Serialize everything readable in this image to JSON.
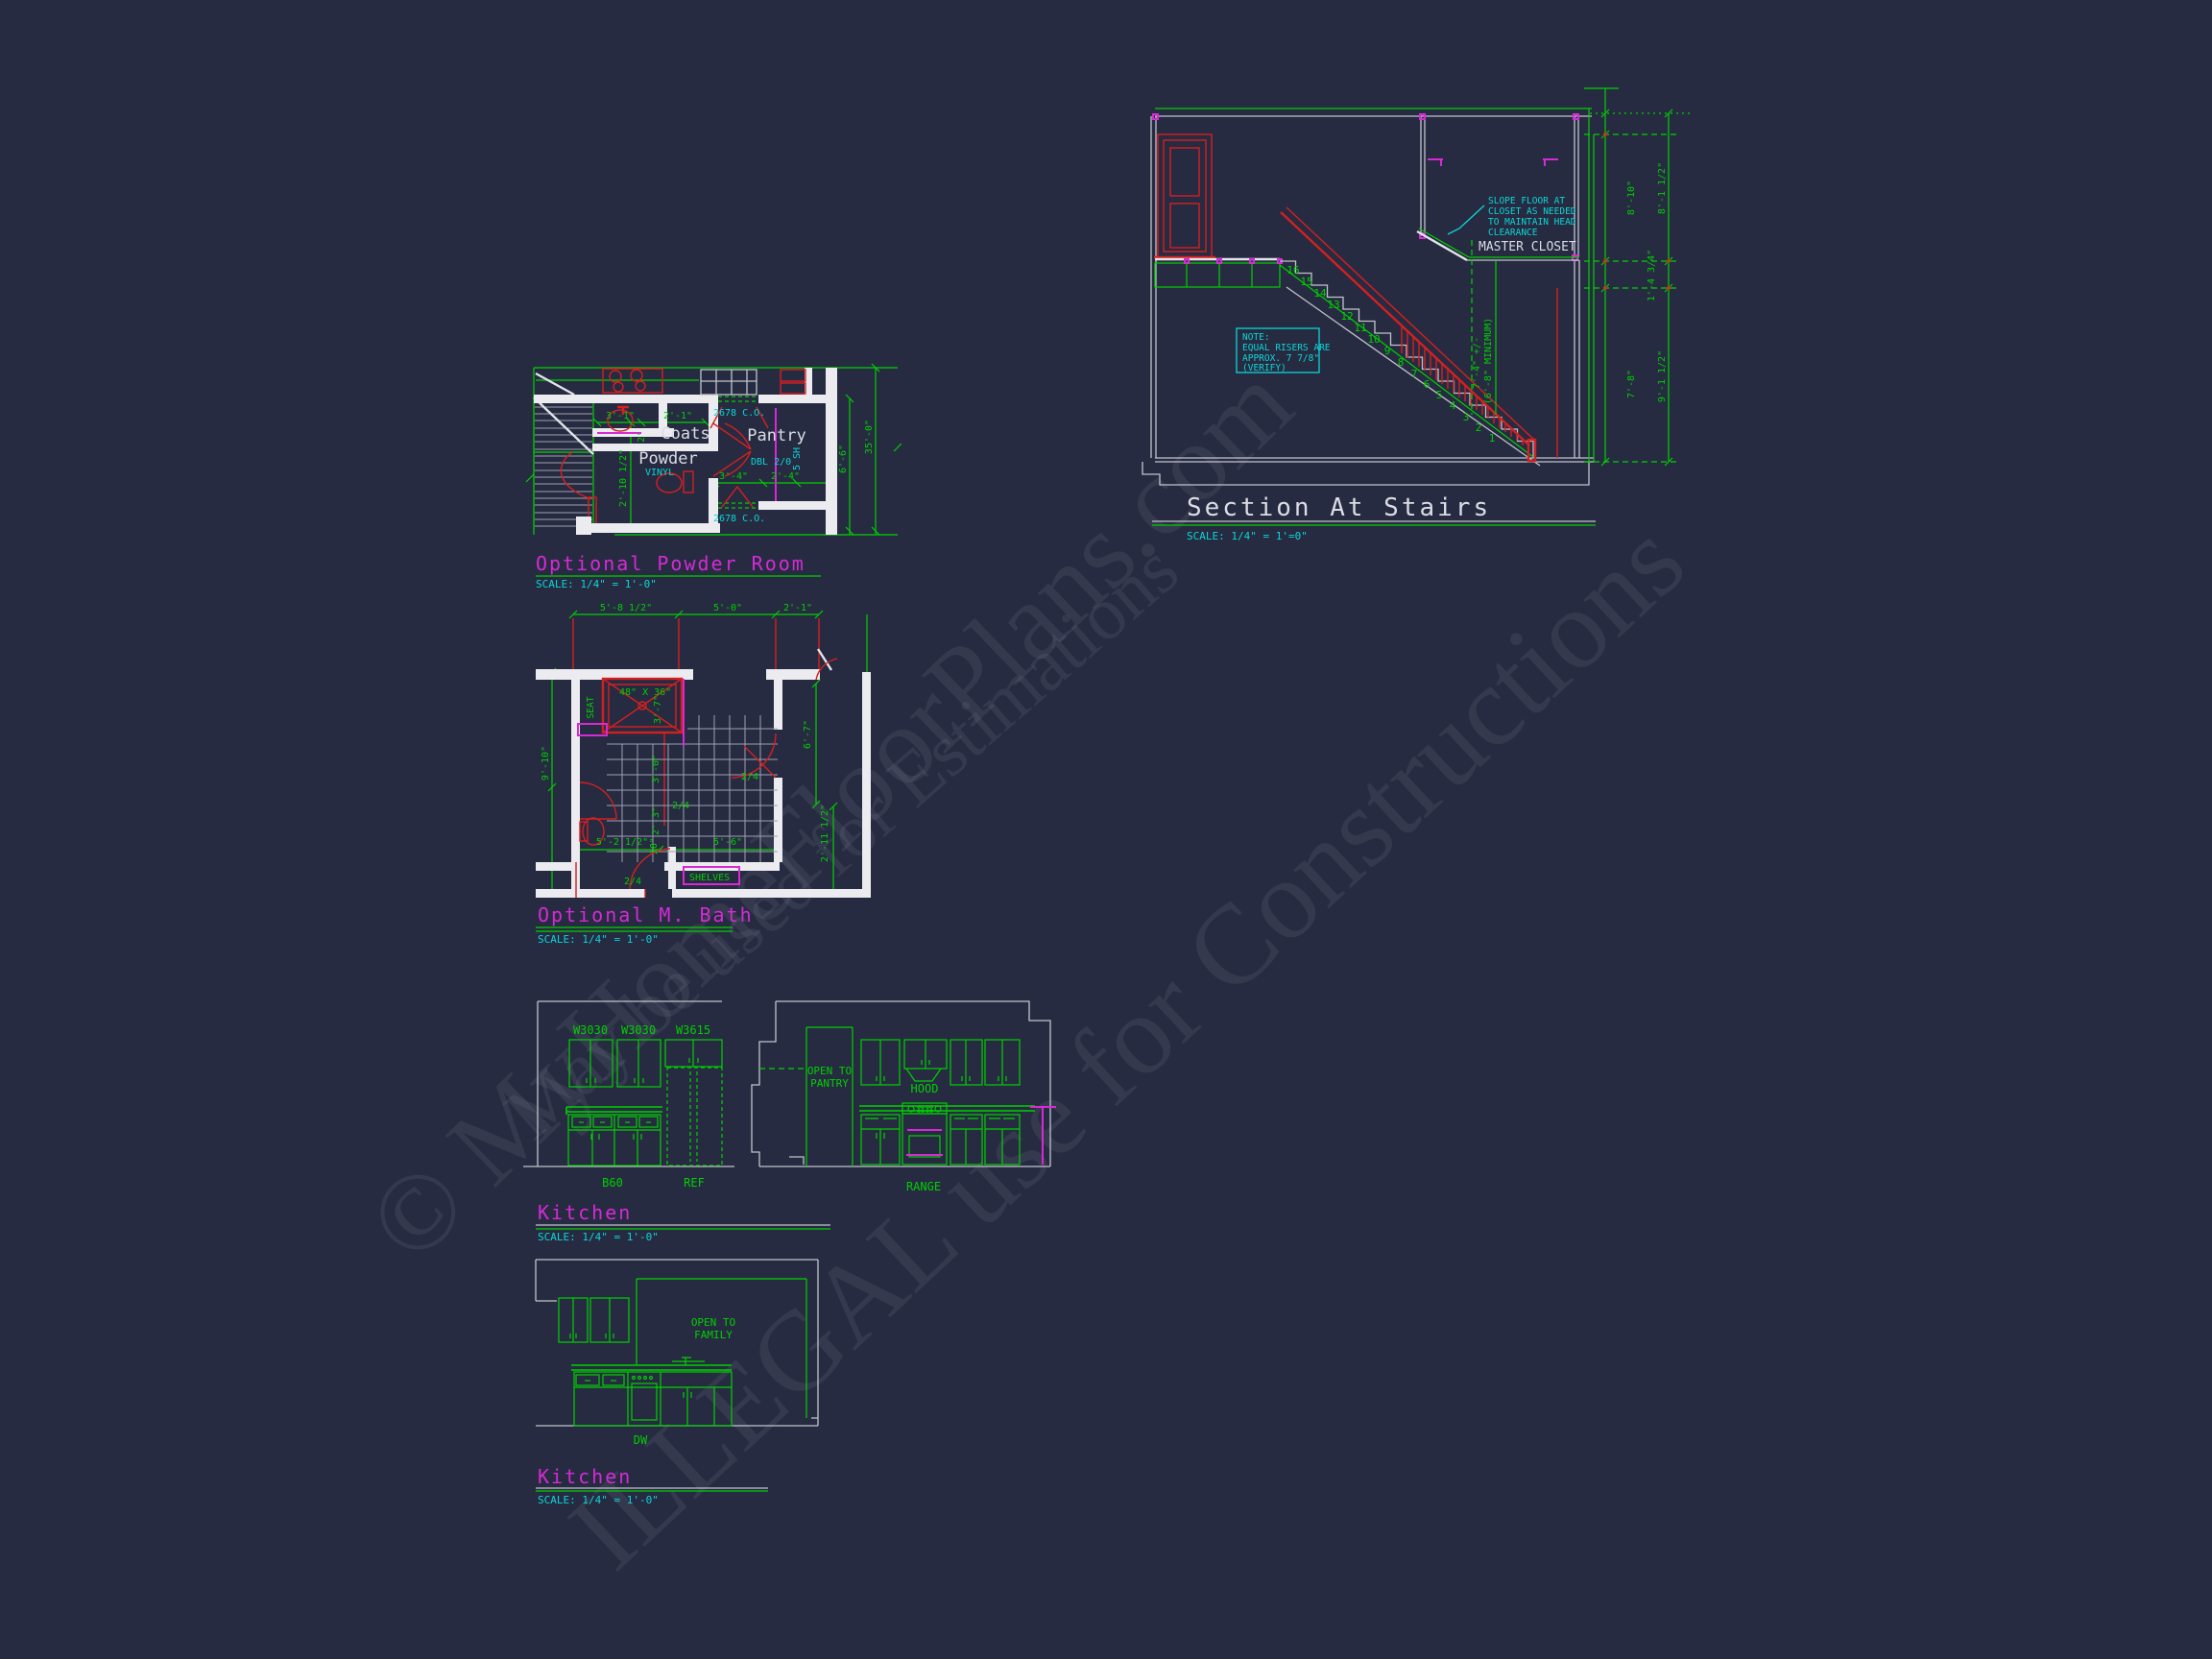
{
  "drawing": {
    "watermark": {
      "line1": "© MyHomeFloorPlans.com",
      "line2": "May be used for Estimations",
      "line3": "ILLEGAL use for Constructions"
    },
    "powder_room": {
      "title": "Optional Powder Room",
      "scale": "SCALE: 1/4\" = 1'-0\"",
      "labels": {
        "coats": "Coats",
        "pantry": "Pantry",
        "powder": "Powder",
        "vinyl": "VINYL",
        "dbl": "DBL 2/0",
        "sh": "5 SH",
        "co_top": "2678 C.O.",
        "co_bottom": "2678 C.O."
      },
      "dims": {
        "d1": "3'-1\"",
        "d2": "2'-1\"",
        "d3": "2'",
        "d4": "2'-10 1/2\"",
        "d5": "3'-4\"",
        "d6": "2'-4\"",
        "d7": "6'-6\"",
        "d8": "35'-0\""
      }
    },
    "stairs": {
      "title": "Section At Stairs",
      "scale": "SCALE: 1/4\" = 1'=0\"",
      "closet_label": "MASTER CLOSET",
      "slope_note": [
        "SLOPE FLOOR AT",
        "CLOSET AS NEEDED",
        "TO MAINTAIN HEAD",
        "CLEARANCE"
      ],
      "riser_note": [
        "NOTE:",
        "EQUAL RISERS ARE",
        "APPROX. 7 7/8\"",
        "(VERIFY)"
      ],
      "risers": [
        "1",
        "2",
        "3",
        "4",
        "5",
        "6",
        "7",
        "8",
        "9",
        "10",
        "11",
        "12",
        "13",
        "14",
        "15",
        "16"
      ],
      "dims": {
        "headroom": "7'-4\" +/-",
        "headroom_min": "(6'-8\" MINIMUM)",
        "right_inner_top": "8'-10\"",
        "right_outer_top": "8'-1 1/2\"",
        "right_mid": "1'-4 3/4\"",
        "right_inner_bottom": "7'-8\"",
        "right_outer_bottom": "9'-1 1/2\""
      }
    },
    "mbath": {
      "title": "Optional M. Bath",
      "scale": "SCALE: 1/4\" = 1'-0\"",
      "labels": {
        "seat": "SEAT",
        "shower_size": "48\" X 36\"",
        "shelves": "SHELVES",
        "door1": "2/4",
        "door2": "2/4",
        "door3": "2/4"
      },
      "dims": {
        "top1": "5'-8 1/2\"",
        "top2": "5'-0\"",
        "top3": "2'-1\"",
        "left": "9'-10\"",
        "shower_d": "3'-7\"",
        "mid1": "3'-0\"",
        "mid2": "2'-3\"",
        "mid3": "18\"",
        "bottom1": "5'-2 1/2\"",
        "bottom2": "5'-6\"",
        "right1": "6'-7\"",
        "right2": "2'-11 1/2\""
      }
    },
    "kitchen_elev": {
      "title": "Kitchen",
      "scale": "SCALE: 1/4\" = 1'-0\"",
      "cabinets": {
        "w1": "W3030",
        "w2": "W3030",
        "w3": "W3615",
        "b1": "B60",
        "ref": "REF"
      },
      "open_pantry": [
        "OPEN TO",
        "PANTRY"
      ],
      "hood": "HOOD",
      "range": "RANGE"
    },
    "kitchen_elev2": {
      "title": "Kitchen",
      "scale": "SCALE: 1/4\" = 1'-0\"",
      "open_family": [
        "OPEN TO",
        "FAMILY"
      ],
      "dw": "DW"
    }
  }
}
